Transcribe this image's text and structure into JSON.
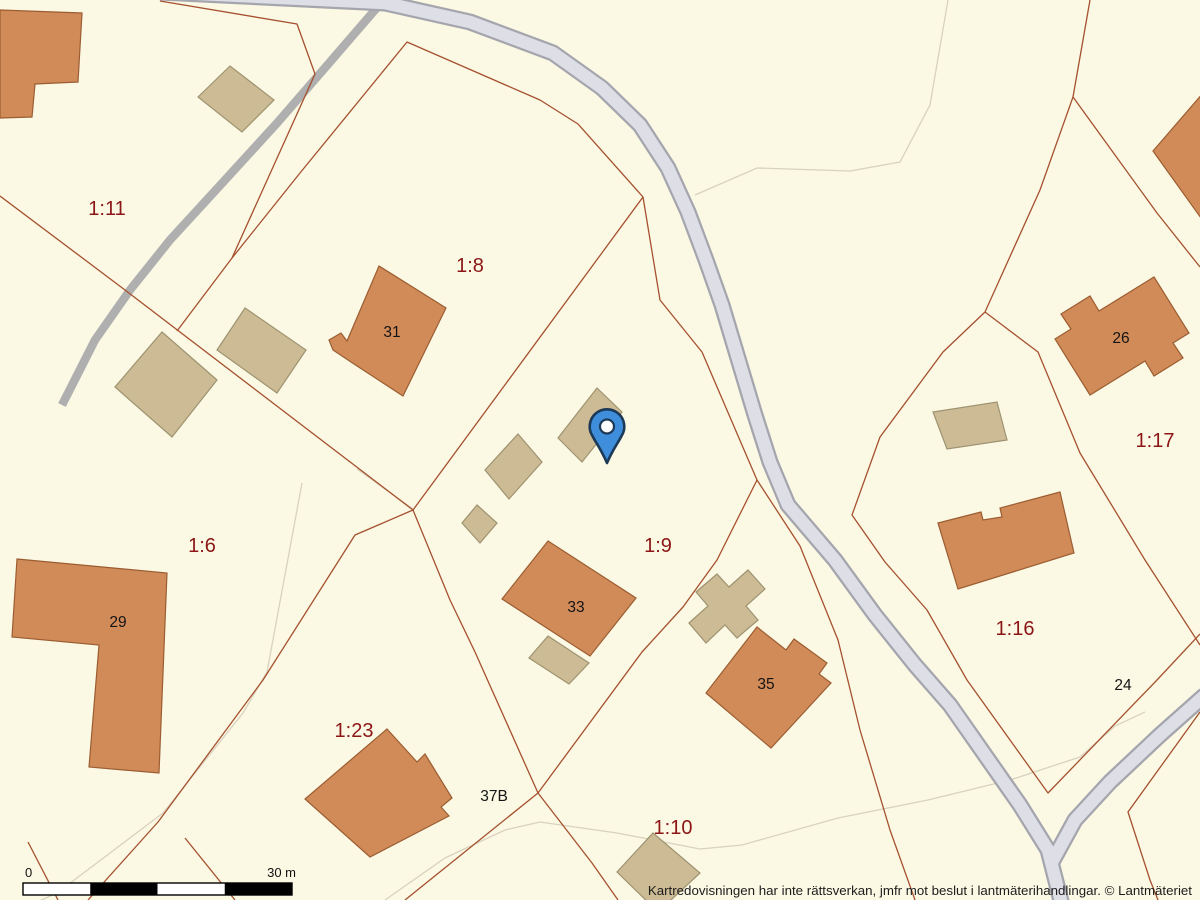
{
  "map": {
    "background": "#FBF8E4",
    "colors": {
      "boundary": "#A5512F",
      "thin_path": "#D8D2BE",
      "driveway": "#AFAFAF",
      "road_casing": "#A5A5AE",
      "road_fill": "#DEDEE6",
      "house_fill": "#D18B59",
      "house_stroke": "#9B5D31",
      "outbuilding_fill": "#CCBB95",
      "outbuilding_stroke": "#9E9370",
      "marker_fill": "#3F8EDC",
      "marker_border": "#1C3A57",
      "marker_dot": "#FFFFFF",
      "parcel_label": "#8C1616",
      "house_number": "#141414"
    },
    "parcel_labels": [
      {
        "text": "1:11",
        "x": 107,
        "y": 215
      },
      {
        "text": "1:8",
        "x": 470,
        "y": 272
      },
      {
        "text": "1:6",
        "x": 202,
        "y": 552
      },
      {
        "text": "1:9",
        "x": 658,
        "y": 552
      },
      {
        "text": "1:17",
        "x": 1155,
        "y": 447
      },
      {
        "text": "1:16",
        "x": 1015,
        "y": 635
      },
      {
        "text": "1:23",
        "x": 354,
        "y": 737
      },
      {
        "text": "1:10",
        "x": 673,
        "y": 834
      }
    ],
    "house_numbers": [
      {
        "text": "31",
        "x": 392,
        "y": 337
      },
      {
        "text": "29",
        "x": 118,
        "y": 627
      },
      {
        "text": "33",
        "x": 576,
        "y": 612
      },
      {
        "text": "35",
        "x": 766,
        "y": 689
      },
      {
        "text": "26",
        "x": 1121,
        "y": 343
      },
      {
        "text": "24",
        "x": 1123,
        "y": 690
      },
      {
        "text": "37B",
        "x": 494,
        "y": 801
      }
    ],
    "scale_bar": {
      "x": 23,
      "y": 883,
      "width": 269,
      "height": 12,
      "segments": 4,
      "label_start": "0",
      "label_end": "30 m"
    },
    "attribution": "Kartredovisningen har inte rättsverkan, jmfr mot beslut i lantmäterihandlingar. © Lantmäteriet",
    "marker": {
      "x": 607,
      "y": 427
    },
    "geometry": {
      "thin_paths": [
        "695,195 757,168 850,171 900,162 930,105 948,0",
        "385,900 445,858 505,830 540,822 617,833 700,849 742,845 838,818 928,800 1010,780 1080,757 1115,726 1145,712",
        "302,483 267,672 243,713 163,813 57,893 30,905",
        "357,469 413,509"
      ],
      "driveway": "387,-4 330,62 278,122 225,180 170,240 130,290 95,340 62,405",
      "boundaries": [
        "0,196 125,290 413,510",
        "160,1 297,24 315,74 232,258 177,331",
        "232,258 300,173 407,42 540,100 578,124 643,197 660,300 702,352 757,480 717,560 683,607 642,652 538,793 405,900",
        "413,510 643,197",
        "413,510 450,600 475,652 538,793 592,863 618,900",
        "413,510 355,535 263,680 158,822 88,900",
        "28,842 58,900",
        "185,838 235,900",
        "1090,0 1073,97",
        "1073,97 1157,213 1200,267",
        "1073,97 1040,190 985,312",
        "985,312 943,352 880,437 852,515 885,562 927,610 967,680 1048,793 1157,680 1200,634",
        "985,312 1038,352 1080,453 1145,560 1200,645",
        "1200,712 1128,812 1150,880 1160,905",
        "757,480 800,546 838,640 860,730 890,830 915,900"
      ],
      "roads": [
        "160,-8 385,3 470,22 553,53 602,88 640,125 668,168 688,212 706,260 722,305 740,365 755,415 770,462 788,505 835,560 875,615 915,665 950,705 985,755 1020,805 1048,850 1062,905",
        "1205,695 1160,735 1110,782 1075,820 1052,862"
      ],
      "buildings": [
        {
          "type": "house",
          "points": "0,10 82,13 78,82 35,84 32,117 0,118"
        },
        {
          "type": "outbuilding",
          "points": "198,97 230,66 274,100 242,132"
        },
        {
          "type": "outbuilding",
          "points": "162,332 217,380 172,437 115,387"
        },
        {
          "type": "outbuilding",
          "points": "245,308 306,350 277,393 217,350"
        },
        {
          "type": "house",
          "points": "379,266 446,308 403,396 354,364 333,350 329,340 341,333 347,341"
        },
        {
          "type": "outbuilding",
          "points": "518,434 542,462 509,499 485,470"
        },
        {
          "type": "outbuilding",
          "points": "477,505 497,523 480,543 462,523"
        },
        {
          "type": "outbuilding",
          "points": "597,388 622,412 582,462 558,438"
        },
        {
          "type": "outbuilding",
          "points": "548,636 589,663 569,684 529,658"
        },
        {
          "type": "house",
          "points": "548,541 636,598 590,656 502,599"
        },
        {
          "type": "outbuilding",
          "points": "689,623 708,606 696,592 717,574 729,587 748,570 765,589 746,606 758,620 737,638 725,625 706,643"
        },
        {
          "type": "house",
          "points": "757,627 786,650 794,639 827,663 819,674 831,683 771,748 706,693"
        },
        {
          "type": "house",
          "points": "17,559 167,573 159,773 89,767 99,645 12,637"
        },
        {
          "type": "house",
          "points": "387,729 417,762 425,754 452,798 441,807 449,816 370,857 305,799"
        },
        {
          "type": "outbuilding",
          "points": "653,833 700,873 658,912 617,872"
        },
        {
          "type": "house",
          "points": "1153,151 1210,85 1290,175 1201,218"
        },
        {
          "type": "house",
          "points": "1055,339 1071,329 1061,314 1090,296 1099,311 1154,277 1189,333 1173,343 1183,358 1154,376 1145,361 1090,395"
        },
        {
          "type": "house",
          "points": "938,523 981,512 983,520 1002,517 1000,508 1060,492 1074,553 958,589"
        },
        {
          "type": "outbuilding",
          "points": "933,412 997,402 1007,440 947,449"
        }
      ]
    }
  }
}
